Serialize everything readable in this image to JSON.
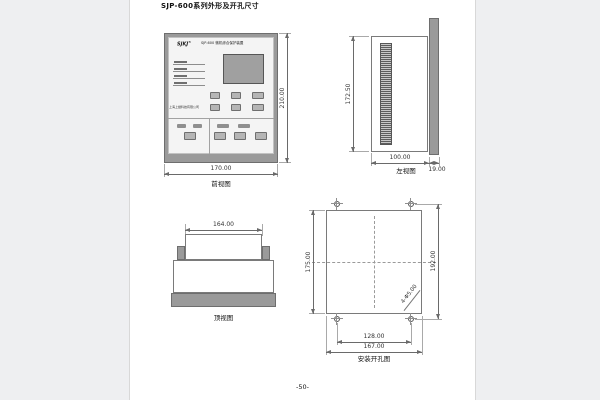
{
  "page": {
    "title": "SJP-600系列外形及开孔尺寸",
    "footer": "-50-"
  },
  "colors": {
    "canvas_bg": "#eeeff1",
    "page_bg": "#ffffff",
    "panel_gray": "#9a9a9a",
    "drawing_line": "#6e6e6e"
  },
  "front_view": {
    "caption": "前视图",
    "logo": "SJKJ",
    "logo_sup": "®",
    "model_text": "SJP-600 微机综合保护装置",
    "company": "上海上继科技有限公司",
    "dim_width": "170.00",
    "dim_height": "210.00"
  },
  "side_view": {
    "caption": "左视图",
    "dim_height": "172.50",
    "dim_depth": "100.00",
    "dim_panel_thickness": "19.00"
  },
  "top_view": {
    "caption": "顶视图",
    "dim_width": "164.00"
  },
  "cutout_view": {
    "caption": "安装开孔图",
    "dim_cutout_height": "175.00",
    "dim_hole_v_spacing": "192.00",
    "dim_hole_h_spacing": "128.00",
    "dim_cutout_width": "167.00",
    "hole_note": "4-Φ5.00"
  }
}
